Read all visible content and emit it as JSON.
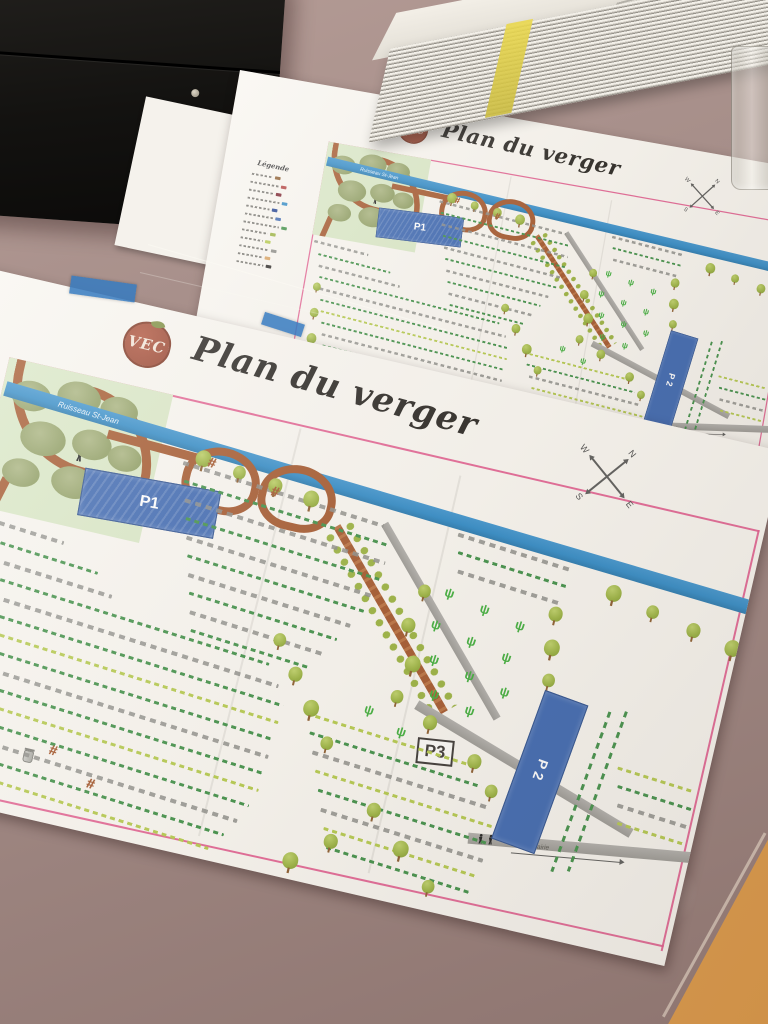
{
  "map": {
    "logo_text": "VEC",
    "title": "Plan du verger",
    "legend_title": "Légende",
    "river_label": "Ruisseau St-Jean",
    "pond1_label": "P1",
    "pond2_label": "P2",
    "p3_label": "P3",
    "road_label": "de la mairie",
    "compass": {
      "north": "N",
      "east": "E",
      "south": "S",
      "west": "W"
    }
  },
  "icons": {
    "picnic_table_glyph": "#",
    "grass_tuft_glyph": "ψ"
  },
  "colors": {
    "paper": "#f8f5ef",
    "map_border_pink": "#e0568a",
    "river_blue": "#2f89c5",
    "pond_blue": "#3b66b0",
    "path_brown": "#a3562b",
    "road_gray": "#a19f9a",
    "tree_green": "#9ab23f",
    "tree_olive": "#8d9c60",
    "row_green": "#3f8f46",
    "row_lightgreen": "#b4c94b",
    "table_mauve": "#a5908b",
    "floor_tan": "#d9a15e",
    "logo_red": "#9c462f",
    "tape_blue": "#3a7fc4",
    "ink": "#2b2825"
  }
}
